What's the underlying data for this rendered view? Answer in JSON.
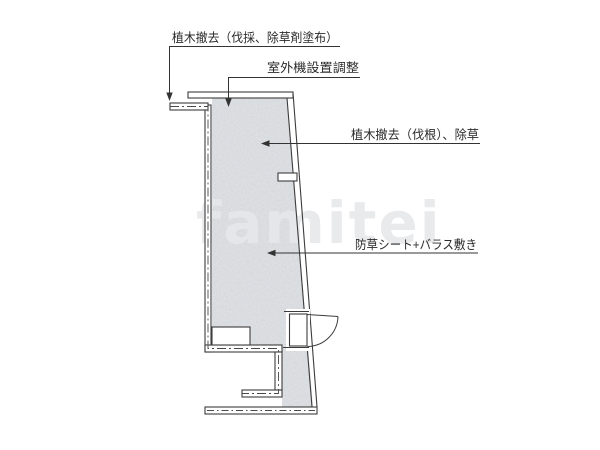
{
  "diagram": {
    "watermark": "famitei",
    "labels": [
      {
        "id": "tree-removal-cut",
        "text": "植木撤去（伐採、除草剤塗布）"
      },
      {
        "id": "outdoor-unit",
        "text": "室外機設置調整"
      },
      {
        "id": "tree-removal-root",
        "text": "植木撤去（伐根）、除草"
      },
      {
        "id": "weed-sheet-gravel",
        "text": "防草シート+バラス敷き"
      }
    ],
    "colors": {
      "line": "#3c3c3c",
      "leader": "#333333",
      "stipple_base": "#e2e4e7",
      "background": "#ffffff",
      "watermark": "#e7e8eb"
    }
  }
}
